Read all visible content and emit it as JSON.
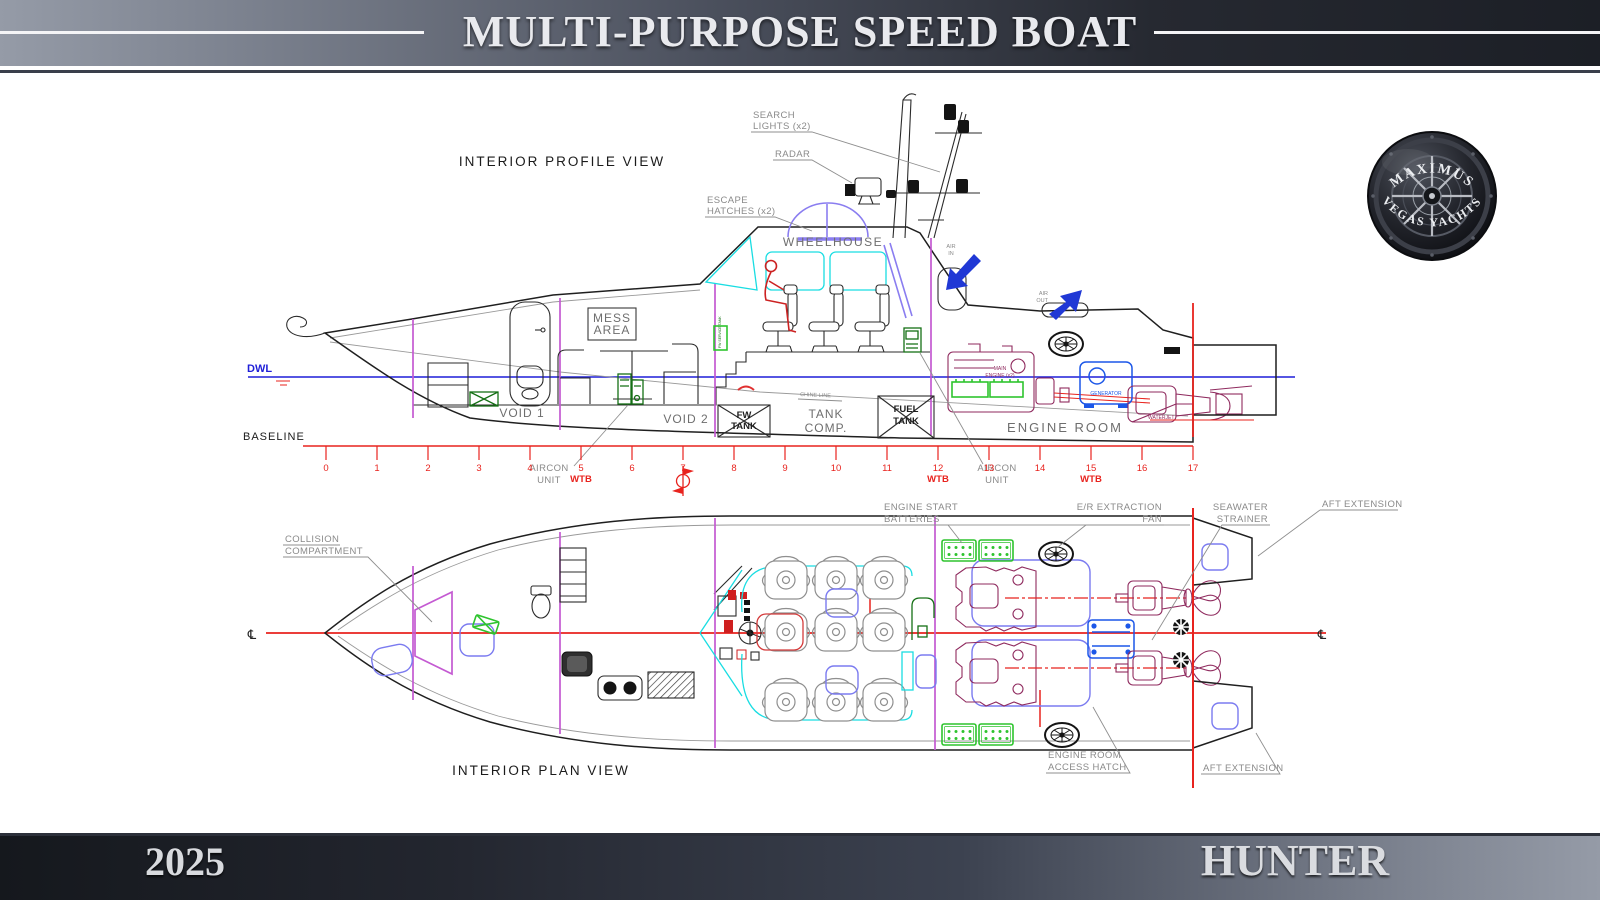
{
  "header": {
    "title": "MULTI-PURPOSE SPEED BOAT"
  },
  "footer": {
    "year": "2025",
    "name": "HUNTER"
  },
  "logo": {
    "arc_top": "MAXIMUS",
    "arc_bottom": "VEGAS YACHTS"
  },
  "profile": {
    "title": "INTERIOR PROFILE VIEW",
    "callouts": {
      "search_lights": [
        "SEARCH",
        "LIGHTS (x2)"
      ],
      "radar": "RADAR",
      "escape_hatches": [
        "ESCAPE",
        "HATCHES (x2)"
      ],
      "aircon_fwd": [
        "AIRCON",
        "UNIT"
      ],
      "aircon_aft": [
        "AIRCON",
        "UNIT"
      ]
    },
    "rooms": {
      "wheelhouse": "WHEELHOUSE",
      "mess_area": [
        "MESS",
        "AREA"
      ],
      "void1": "VOID 1",
      "void2": "VOID 2",
      "fw_tank": [
        "FW",
        "TANK"
      ],
      "tank_comp": [
        "TANK",
        "COMP."
      ],
      "fuel_tank": [
        "FUEL",
        "TANK"
      ],
      "engine_room": "ENGINE ROOM"
    },
    "equipment": {
      "main_engine": [
        "MAIN",
        "ENGINE (x2)"
      ],
      "generator": "GENERATOR",
      "waterjet": "WATERJET",
      "service_tank": "FW SERVICE TANK",
      "air_in": [
        "AIR",
        "IN"
      ],
      "air_out": [
        "AIR",
        "OUT"
      ],
      "chine_line": "CHINE LINE"
    },
    "lines": {
      "dwl": "DWL",
      "baseline": "BASELINE"
    },
    "ruler": {
      "marks": [
        "0",
        "1",
        "2",
        "3",
        "4",
        "5",
        "6",
        "7",
        "8",
        "9",
        "10",
        "11",
        "12",
        "13",
        "14",
        "15",
        "16",
        "17"
      ],
      "wtb": "WTB"
    }
  },
  "plan": {
    "title": "INTERIOR PLAN VIEW",
    "callouts": {
      "collision": [
        "COLLISION",
        "COMPARTMENT"
      ],
      "batteries": [
        "ENGINE START",
        "BATTERIES"
      ],
      "er_fan": [
        "E/R EXTRACTION",
        "FAN"
      ],
      "strainer": [
        "SEAWATER",
        "STRAINER"
      ],
      "aft_ext_top": "AFT EXTENSION",
      "access_hatch": [
        "ENGINE ROOM",
        "ACCESS HATCH"
      ],
      "aft_ext_bottom": "AFT EXTENSION"
    },
    "centerline_symbol": "℄"
  },
  "colors": {
    "accent_red": "#e8231e",
    "dwl_blue": "#1f1fd8",
    "bulkhead_magenta": "#c45ad2",
    "window_cyan": "#19dde2",
    "equipment_green": "#157015",
    "engine_maroon": "#8f2a5e",
    "generator_blue": "#1c57e8",
    "hatch_blue": "#7b7bf0",
    "callout_gray": "#8a8a8a",
    "band_dark": "#1c1f26",
    "band_light": "#959ba7"
  }
}
